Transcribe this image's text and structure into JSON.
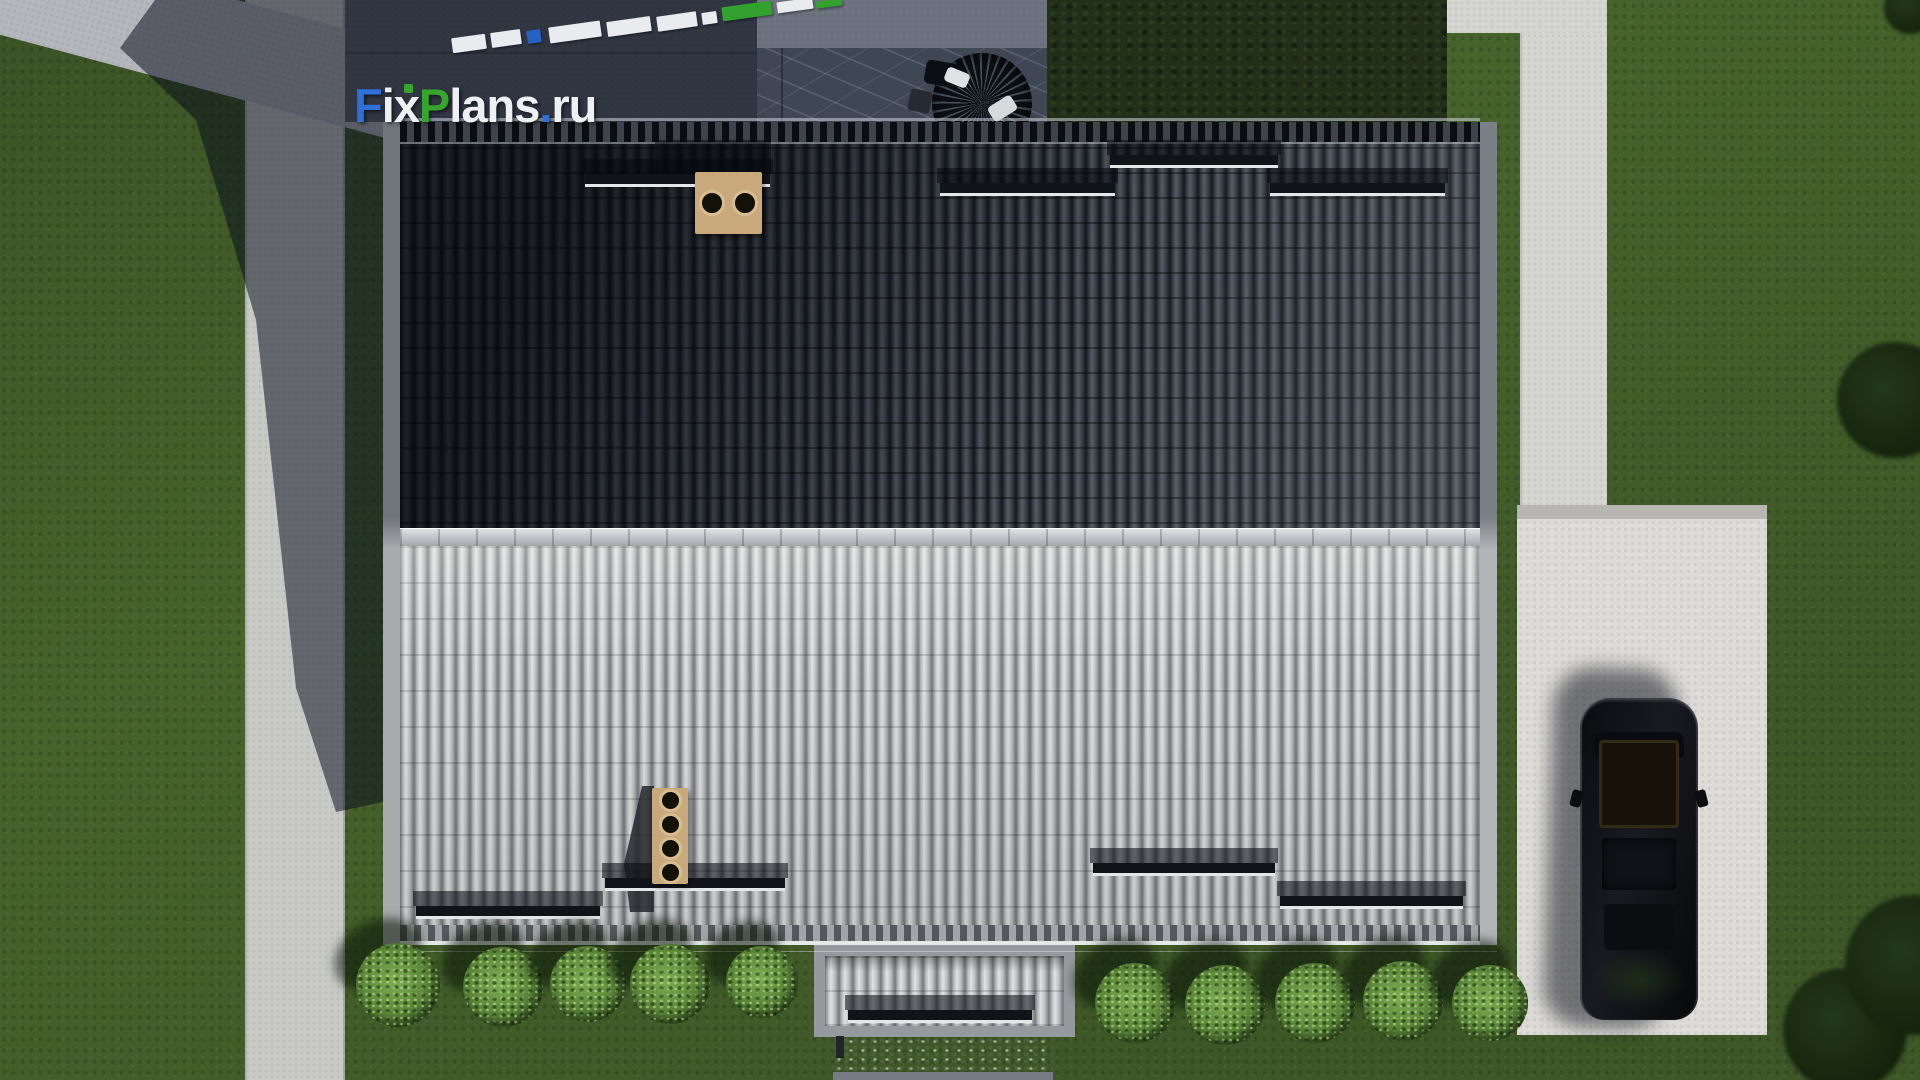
{
  "watermark": {
    "text": "FixPlans.ru",
    "segments": [
      {
        "text": "F",
        "color": "#2f6fd8"
      },
      {
        "text": "ix",
        "color": "#eef0f2"
      },
      {
        "text": "P",
        "color": "#35a52c"
      },
      {
        "text": "lans",
        "color": "#eef0f2"
      },
      {
        "text": ".",
        "color": "#2f6fd8"
      },
      {
        "text": "ru",
        "color": "#eef0f2"
      }
    ]
  },
  "scene": {
    "objects": [
      "lawn",
      "left-sidewalk",
      "corner-road",
      "building-wall-corner",
      "top-concrete-walk",
      "stone-patio",
      "patio-furniture",
      "hedge",
      "house-roof-dark-slope",
      "house-roof-light-slope",
      "roof-ridge",
      "chimney-two-flues",
      "chimney-four-flues",
      "snow-guard-bars",
      "gable-bump-out",
      "entrance-porch",
      "right-sidewalk",
      "parking-pad",
      "black-car",
      "garden-bushes",
      "trees",
      "cast-shadow",
      "3d-logo-blocks"
    ],
    "colors": {
      "lawn": "#47632c",
      "left-sidewalk": "#c9cac6",
      "corner-road": "#b4b7bb",
      "corner-wall": "#d6d7d4",
      "corner-wall-edge": "#7d818c",
      "top-concrete": "#5e6470",
      "patio-upper": "#6d7380",
      "stone-patio": "#3f4654",
      "hedge": "#22301a",
      "right-walk-h": "#d5d5d1",
      "right-walk-v": "#d5d5d1",
      "parking-border": "#b7b6b2",
      "parking-pad": "#dddcd8",
      "dark-slope": "#5c6068",
      "light-slope": "#b4b6b8"
    },
    "snow_guards_dark": [
      {
        "x": 585,
        "y": 174,
        "w": 185
      },
      {
        "x": 940,
        "y": 183,
        "w": 175
      },
      {
        "x": 1110,
        "y": 155,
        "w": 168
      },
      {
        "x": 1270,
        "y": 183,
        "w": 175
      }
    ],
    "snow_guards_light": [
      {
        "x": 416,
        "y": 906,
        "w": 184
      },
      {
        "x": 605,
        "y": 878,
        "w": 180
      },
      {
        "x": 1093,
        "y": 863,
        "w": 182
      },
      {
        "x": 1280,
        "y": 896,
        "w": 183
      }
    ],
    "snow_guard_bump": {
      "x": 848,
      "y": 1010,
      "w": 184
    },
    "chimneys": [
      {
        "x": 695,
        "y": 172,
        "w": 67,
        "h": 62,
        "flues": 2,
        "flue_d": 26
      },
      {
        "x": 652,
        "y": 788,
        "w": 36,
        "h": 96,
        "flues": 4,
        "flue_d": 23
      }
    ],
    "logo_blocks": [
      {
        "x": 452,
        "y": 36,
        "w": 34,
        "h": 15,
        "color": "#e9ebee"
      },
      {
        "x": 491,
        "y": 31,
        "w": 30,
        "h": 15,
        "color": "#e9ebee"
      },
      {
        "x": 527,
        "y": 30,
        "w": 14,
        "h": 13,
        "color": "#2562c4"
      },
      {
        "x": 549,
        "y": 24,
        "w": 52,
        "h": 16,
        "color": "#e9ebee"
      },
      {
        "x": 607,
        "y": 19,
        "w": 44,
        "h": 15,
        "color": "#e9ebee"
      },
      {
        "x": 657,
        "y": 14,
        "w": 40,
        "h": 15,
        "color": "#e9ebee"
      },
      {
        "x": 702,
        "y": 12,
        "w": 15,
        "h": 12,
        "color": "#e9ebee"
      },
      {
        "x": 722,
        "y": 4,
        "w": 50,
        "h": 14,
        "color": "#33a12e"
      },
      {
        "x": 777,
        "y": 0,
        "w": 36,
        "h": 11,
        "color": "#e9ebee"
      },
      {
        "x": 816,
        "y": 0,
        "w": 26,
        "h": 7,
        "color": "#33a12e"
      }
    ],
    "bushes": [
      {
        "cx": 398,
        "cy": 985,
        "r": 42
      },
      {
        "cx": 503,
        "cy": 987,
        "r": 40
      },
      {
        "cx": 588,
        "cy": 984,
        "r": 38
      },
      {
        "cx": 670,
        "cy": 984,
        "r": 40
      },
      {
        "cx": 762,
        "cy": 982,
        "r": 36
      },
      {
        "cx": 1135,
        "cy": 1003,
        "r": 40
      },
      {
        "cx": 1225,
        "cy": 1005,
        "r": 40
      },
      {
        "cx": 1315,
        "cy": 1003,
        "r": 40
      },
      {
        "cx": 1403,
        "cy": 1001,
        "r": 40
      },
      {
        "cx": 1490,
        "cy": 1003,
        "r": 38
      }
    ],
    "trees": [
      {
        "cx": 1895,
        "cy": 400,
        "r": 58
      },
      {
        "cx": 1845,
        "cy": 1030,
        "r": 62
      },
      {
        "cx": 1915,
        "cy": 965,
        "r": 70
      },
      {
        "cx": 1910,
        "cy": 8,
        "r": 26
      }
    ]
  }
}
